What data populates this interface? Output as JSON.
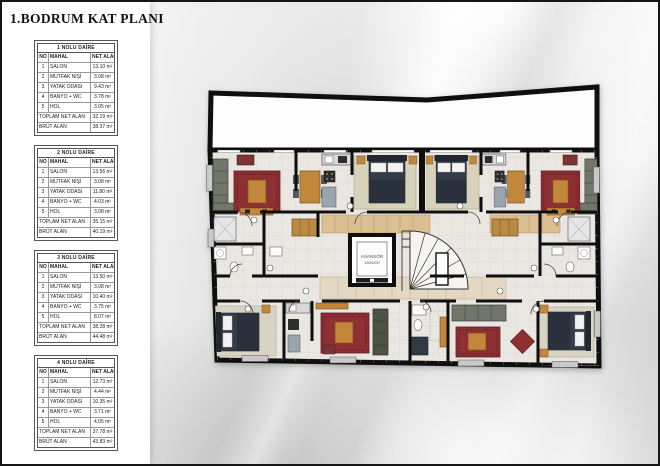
{
  "title": "1.BODRUM KAT PLANI",
  "tables": [
    {
      "name": "1 NOLU DAİRE",
      "columns": [
        "NO",
        "MAHAL",
        "NET ALAN"
      ],
      "rows": [
        [
          "1",
          "SALON",
          "13.10 m²"
        ],
        [
          "2",
          "MUTFAK NİŞİ",
          "3.08 m²"
        ],
        [
          "3",
          "YATAK ODASI",
          "9.43 m²"
        ],
        [
          "4",
          "BANYO + WC",
          "3.78 m²"
        ],
        [
          "5",
          "HOL",
          "3.05 m²"
        ]
      ],
      "total_label": "TOPLAM NET ALAN",
      "total_value": "32.19 m²",
      "gross_label": "BRÜT ALAN",
      "gross_value": "38.37 m²"
    },
    {
      "name": "2 NOLU DAİRE",
      "columns": [
        "NO",
        "MAHAL",
        "NET ALAN"
      ],
      "rows": [
        [
          "1",
          "SALON",
          "13.56 m²"
        ],
        [
          "2",
          "MUTFAK NİŞİ",
          "3.08 m²"
        ],
        [
          "3",
          "YATAK ODASI",
          "11.80 m²"
        ],
        [
          "4",
          "BANYO + WC",
          "4.03 m²"
        ],
        [
          "5",
          "HOL",
          "3.08 m²"
        ]
      ],
      "total_label": "TOPLAM NET ALAN",
      "total_value": "35.15 m²",
      "gross_label": "BRÜT ALAN",
      "gross_value": "40.19 m²"
    },
    {
      "name": "3 NOLU DAİRE",
      "columns": [
        "NO",
        "MAHAL",
        "NET ALAN"
      ],
      "rows": [
        [
          "1",
          "SALON",
          "13.50 m²"
        ],
        [
          "2",
          "MUTFAK NİŞİ",
          "3.08 m²"
        ],
        [
          "3",
          "YATAK ODASI",
          "10.40 m²"
        ],
        [
          "4",
          "BANYO + WC",
          "3.75 m²"
        ],
        [
          "5",
          "HOL",
          "8.07 m²"
        ]
      ],
      "total_label": "TOPLAM NET ALAN",
      "total_value": "38.28 m²",
      "gross_label": "BRÜT ALAN",
      "gross_value": "44.48 m²"
    },
    {
      "name": "4 NOLU DAİRE",
      "columns": [
        "NO",
        "MAHAL",
        "NET ALAN"
      ],
      "rows": [
        [
          "1",
          "SALON",
          "12.73 m²"
        ],
        [
          "2",
          "MUTFAK NİŞİ",
          "4.44 m²"
        ],
        [
          "3",
          "YATAK ODASI",
          "10.35 m²"
        ],
        [
          "4",
          "BANYO + WC",
          "3.71 m²"
        ],
        [
          "5",
          "HOL",
          "4.05 m²"
        ]
      ],
      "total_label": "TOPLAM NET ALAN",
      "total_value": "37.78 m²",
      "gross_label": "BRÜT ALAN",
      "gross_value": "43.83 m²"
    }
  ],
  "plan": {
    "elevator_label": "ASANSÖR",
    "elevator_size": "150x200"
  },
  "colors": {
    "wall": "#111111",
    "floor": "#eae6e1",
    "rug_red": "#8e2f33",
    "wood": "#c3873b",
    "bed": "#343b47",
    "sofa": "#72756a",
    "rug_beige": "#d8d2bc"
  }
}
